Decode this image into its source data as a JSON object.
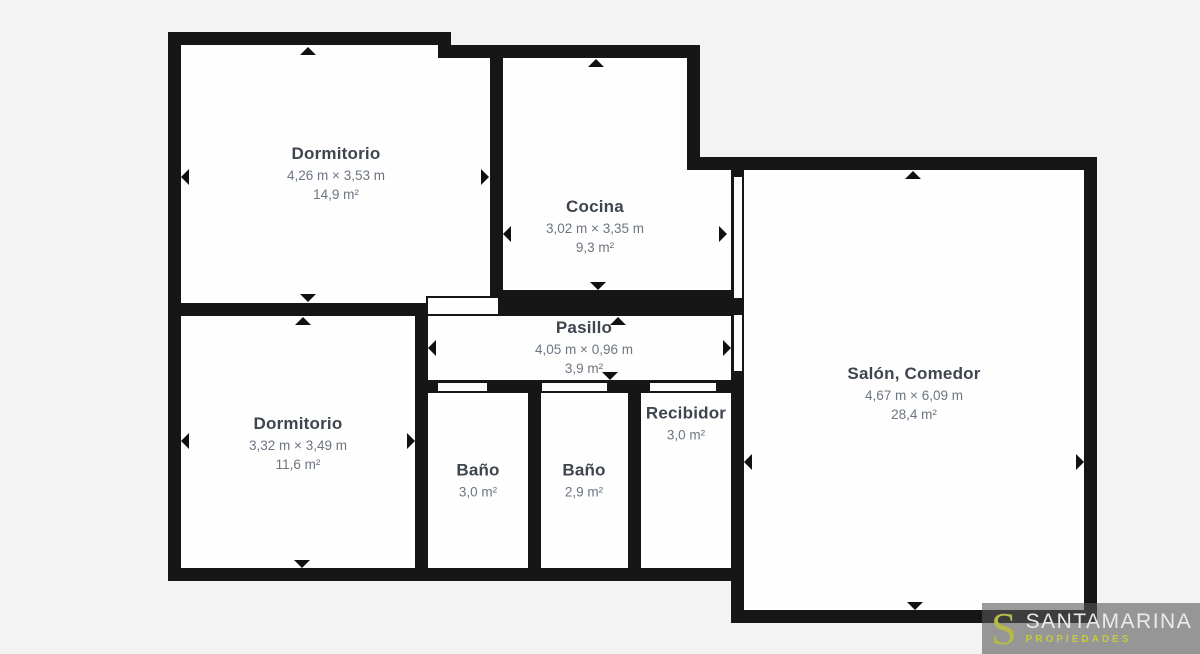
{
  "colors": {
    "background": "#f3f3f4",
    "wall": "#161616",
    "room_fill": "#fefefe",
    "room_title": "#3e454e",
    "room_dims": "#6d7580",
    "logo_box": "#585858",
    "logo_accent": "#c5cb3f",
    "logo_text": "#ebebeb"
  },
  "rooms": [
    {
      "id": "dormitorio-1",
      "name": "Dormitorio",
      "dims": "4,26 m × 3,53 m",
      "area": "14,9 m²"
    },
    {
      "id": "cocina",
      "name": "Cocina",
      "dims": "3,02 m × 3,35 m",
      "area": "9,3 m²"
    },
    {
      "id": "pasillo",
      "name": "Pasillo",
      "dims": "4,05 m × 0,96 m",
      "area": "3,9 m²"
    },
    {
      "id": "salon-comedor",
      "name": "Salón, Comedor",
      "dims": "4,67 m × 6,09 m",
      "area": "28,4 m²"
    },
    {
      "id": "dormitorio-2",
      "name": "Dormitorio",
      "dims": "3,32 m × 3,49 m",
      "area": "11,6 m²"
    },
    {
      "id": "bano-1",
      "name": "Baño",
      "area": "3,0 m²"
    },
    {
      "id": "bano-2",
      "name": "Baño",
      "area": "2,9 m²"
    },
    {
      "id": "recibidor",
      "name": "Recibidor",
      "area": "3,0 m²"
    }
  ],
  "logo": {
    "initial": "S",
    "brand": "SANTAMARINA",
    "tagline": "PROPIEDADES"
  }
}
